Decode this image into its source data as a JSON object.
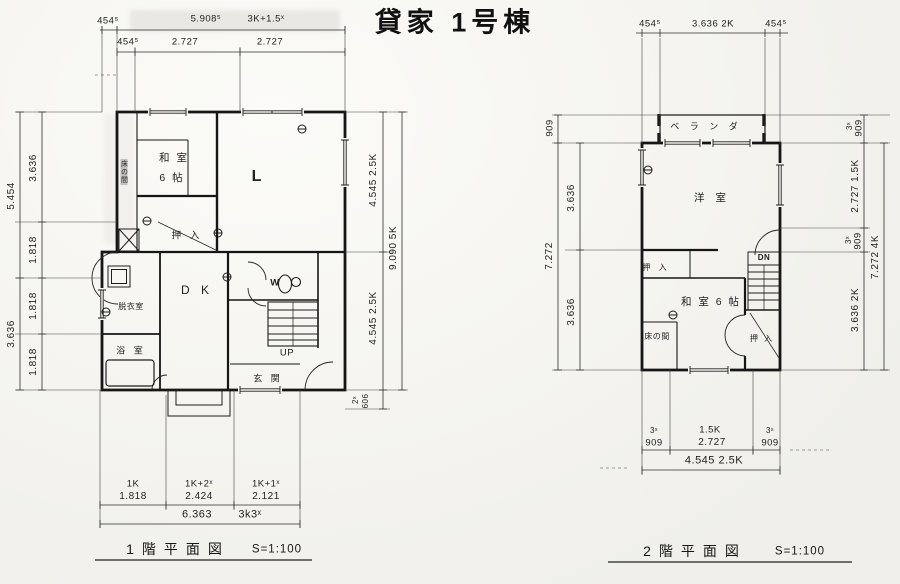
{
  "title": "貸家 1号棟",
  "f1": {
    "caption": "1階平面図",
    "scale": "S=1:100",
    "rooms": {
      "strip": "床の間",
      "washitsu": "和 室",
      "washitsu_size": "6 帖",
      "living": "L",
      "oshiire": "押 入",
      "dk": "D K",
      "dressing": "脱衣室",
      "bath": "浴 室",
      "wc": "W",
      "up": "UP",
      "entrance": "玄 関"
    },
    "dims": {
      "top1_a": "454⁵",
      "top1_b": "5.908⁵",
      "top1_c": "3K+1.5ˣ",
      "top2_a": "454⁵",
      "top2_b": "2.727",
      "top2_c": "2.727",
      "left_out_a": "5.454",
      "left_out_b": "3.636",
      "left_in_a": "3.636",
      "left_in_b": "1.818",
      "left_in_c": "1.818",
      "left_in_d": "1.818",
      "right_in_a": "4.545  2.5K",
      "right_in_b": "4.545  2.5K",
      "right_porch_a": "2ˣ",
      "right_porch_b": "606",
      "right_out": "9.090  5K",
      "bot_a_l": "1K",
      "bot_a_v": "1.818",
      "bot_b_l": "1K+2ˣ",
      "bot_b_v": "2.424",
      "bot_c_l": "1K+1ˣ",
      "bot_c_v": "2.121",
      "bot_total": "6.363",
      "bot_total_l": "3k3ˣ"
    }
  },
  "f2": {
    "caption": "2階平面図",
    "scale": "S=1:100",
    "rooms": {
      "veranda": "ベ ラ ン ダ",
      "western": "洋 室",
      "dn": "DN",
      "oshiire_l": "押 入",
      "washitsu": "和 室 6 帖",
      "tokonoma": "床の間",
      "oshiire_r": "押 入"
    },
    "dims": {
      "top_a": "454⁵",
      "top_b": "3.636 2K",
      "top_c": "454⁵",
      "left_out_a": "909",
      "left_out_b": "7.272",
      "left_in_a": "3.636",
      "left_in_b": "3.636",
      "right_a1": "3ˣ",
      "right_a2": "909",
      "right_b": "2.727 1.5K",
      "right_c1": "3ˣ",
      "right_c2": "909",
      "right_d": "3.636 2K",
      "right_out": "7.272 4K",
      "bot_a1": "3ˣ",
      "bot_a2": "909",
      "bot_b1": "1.5K",
      "bot_b2": "2.727",
      "bot_c1": "3ˣ",
      "bot_c2": "909",
      "bot_total": "4.545  2.5K"
    }
  }
}
